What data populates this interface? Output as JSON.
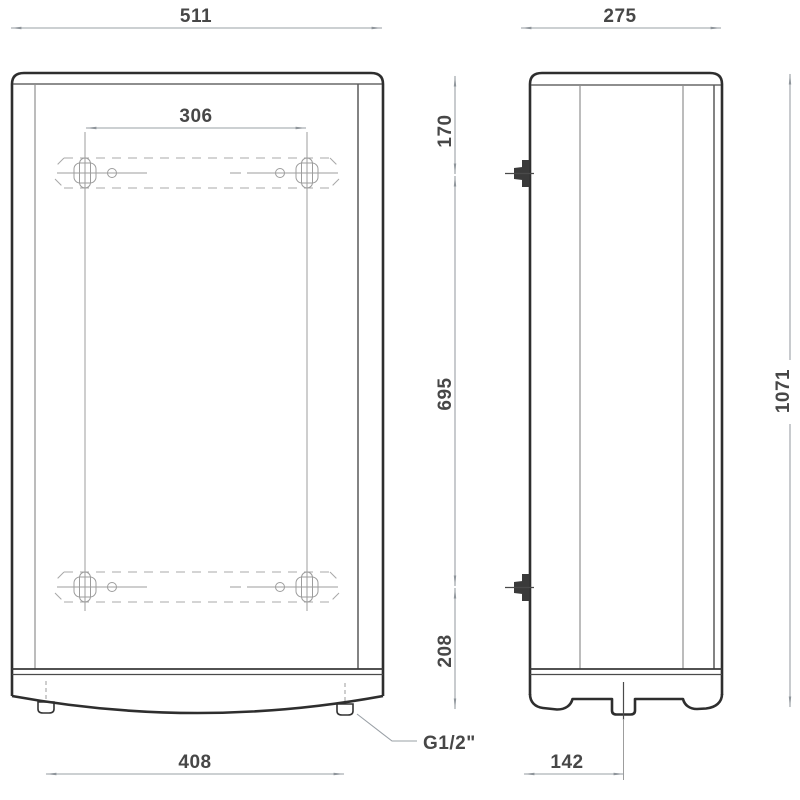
{
  "diagram": {
    "labels": {
      "overall_width": "511",
      "overall_depth": "275",
      "bracket_hole_spacing": "306",
      "top_to_upper_bracket": "170",
      "upper_to_lower_bracket": "695",
      "lower_bracket_to_bottom": "208",
      "overall_height": "1071",
      "pipe_connection_spacing": "408",
      "back_to_pipe_axis": "142",
      "pipe_thread": "G1/2\""
    },
    "colors": {
      "background": "#ffffff",
      "body_outline": "#2e2e2e",
      "dimension_lines": "#9aa0a6",
      "dimension_text": "#474747",
      "phantom_lines": "#a8a8a8"
    }
  }
}
